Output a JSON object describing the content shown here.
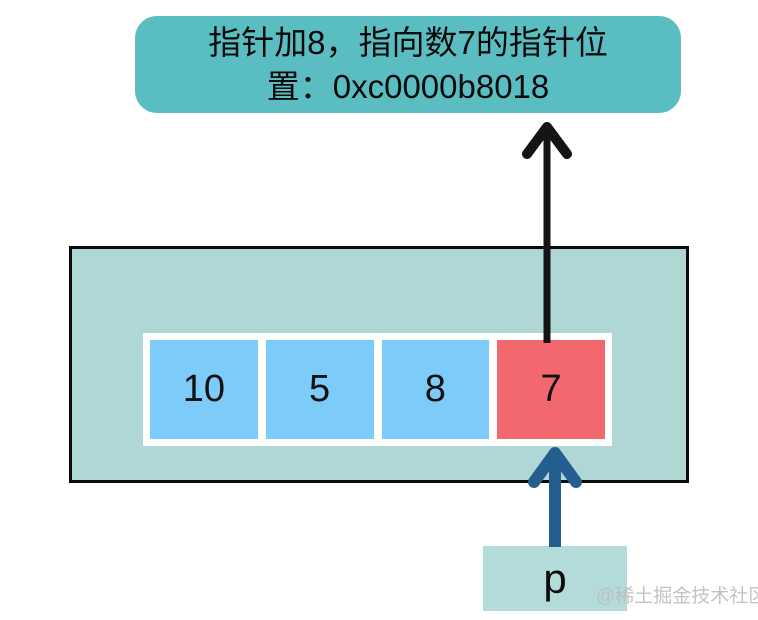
{
  "banner": {
    "lines": [
      "指针加8，指向数7的指针位",
      "置：0xc0000b8018"
    ],
    "full_text": "指针加8，指向数7的指针位置：0xc0000b8018"
  },
  "memory": {
    "cells": [
      {
        "value": "10",
        "highlight": false
      },
      {
        "value": "5",
        "highlight": false
      },
      {
        "value": "8",
        "highlight": false
      },
      {
        "value": "7",
        "highlight": true
      }
    ]
  },
  "pointer": {
    "label": "p"
  },
  "watermark": {
    "text": "@稀土掘金技术社区"
  },
  "colors": {
    "banner_bg": "#5abdc2",
    "memory_bg": "#aed7d5",
    "memory_border": "#0a0a0a",
    "cell_blue": "#7dcbf8",
    "cell_red": "#f3676e",
    "cell_text": "#111111",
    "arrow_black": "#141414",
    "arrow_blue": "#245e8e",
    "pointer_box_bg": "#b3dbda",
    "watermark": "#bdbdbd"
  }
}
